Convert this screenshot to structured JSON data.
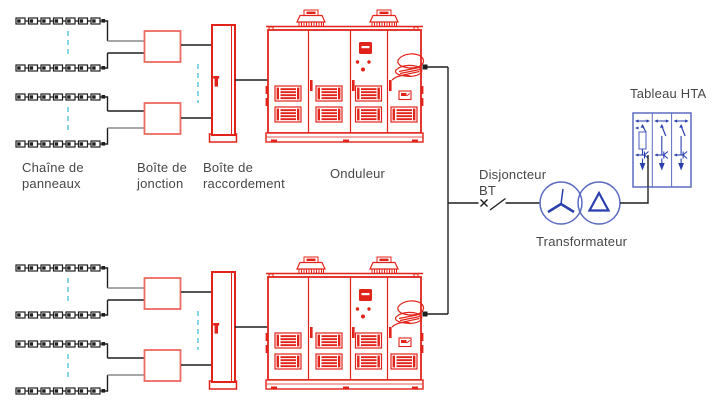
{
  "labels": {
    "panel_string": [
      "Chaîne de",
      "panneaux"
    ],
    "junction_box": [
      "Boîte de",
      "jonction"
    ],
    "connection_box": [
      "Boîte de",
      "raccordement"
    ],
    "inverter": "Onduleur",
    "lv_breaker": [
      "Disjoncteur",
      "BT"
    ],
    "transformer": "Transformateur",
    "mv_switchboard": "Tableau HTA"
  },
  "colors": {
    "red": "#e2231a",
    "red_soft": "#ec6a60",
    "blue_light": "#5b6bbf",
    "blue_dark": "#2a3eae",
    "cyan": "#6fcfe2",
    "line": "#1f1f1f",
    "gray_line": "#8a8a8a",
    "text": "#474747"
  },
  "structure": {
    "branches": 2,
    "strings_per_branch": 4,
    "modules_per_string": 7,
    "junction_boxes_per_branch": 2,
    "inverter_door_panels": 4,
    "switchboard_bays": 3
  }
}
